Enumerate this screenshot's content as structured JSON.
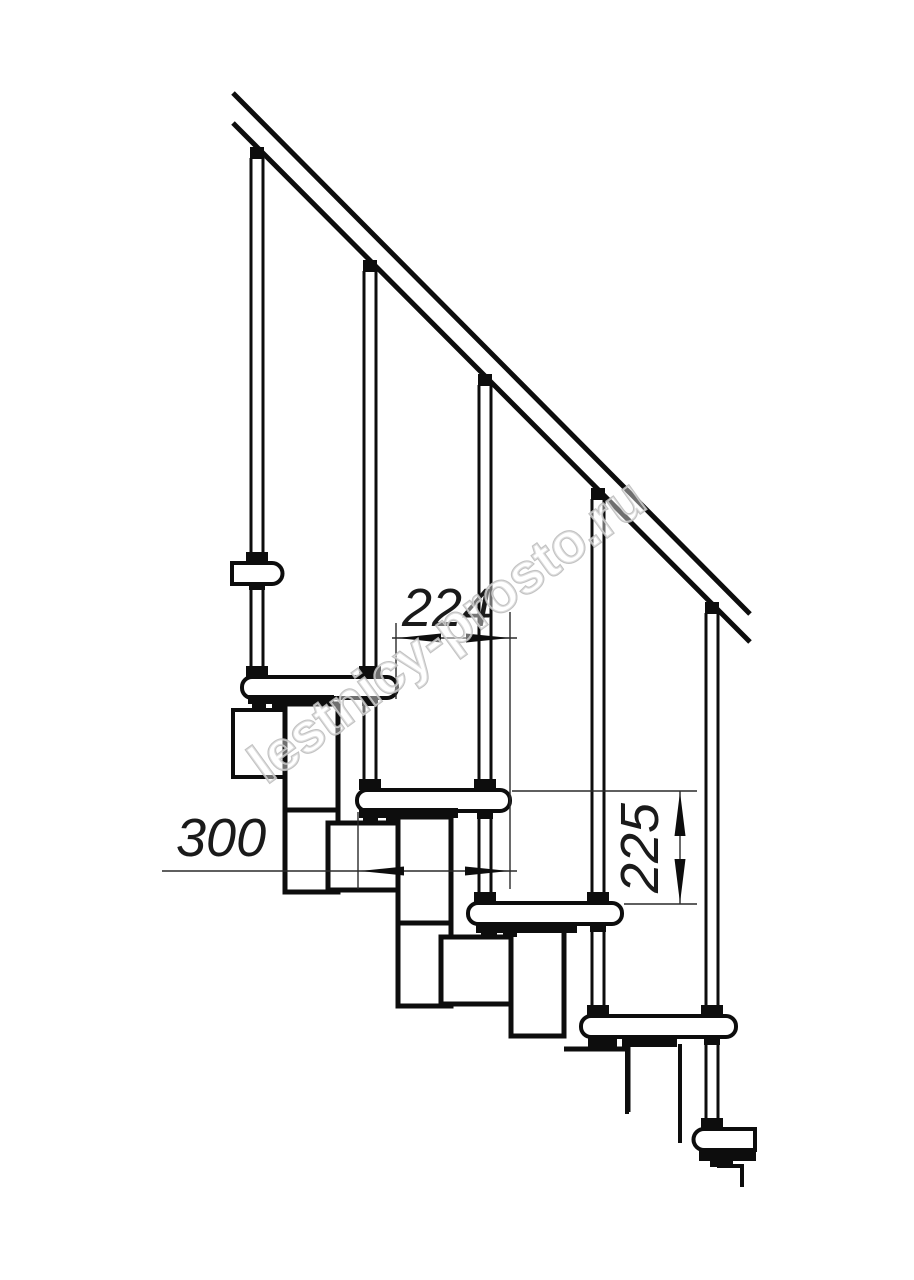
{
  "drawing": {
    "kind": "modular staircase side-view technical drawing",
    "background_color": "#ffffff",
    "line_color": "#0d0d0d",
    "thin_line_color": "#2a2a2a",
    "steps_visible": 5,
    "balusters_visible": 5
  },
  "dimensions": {
    "run": {
      "value": "224",
      "orientation": "horizontal"
    },
    "depth": {
      "value": "300",
      "orientation": "horizontal"
    },
    "riser": {
      "value": "225",
      "orientation": "vertical"
    }
  },
  "watermark": {
    "text": "lestnicy-prosto.ru",
    "color": "#bcbcbc"
  }
}
